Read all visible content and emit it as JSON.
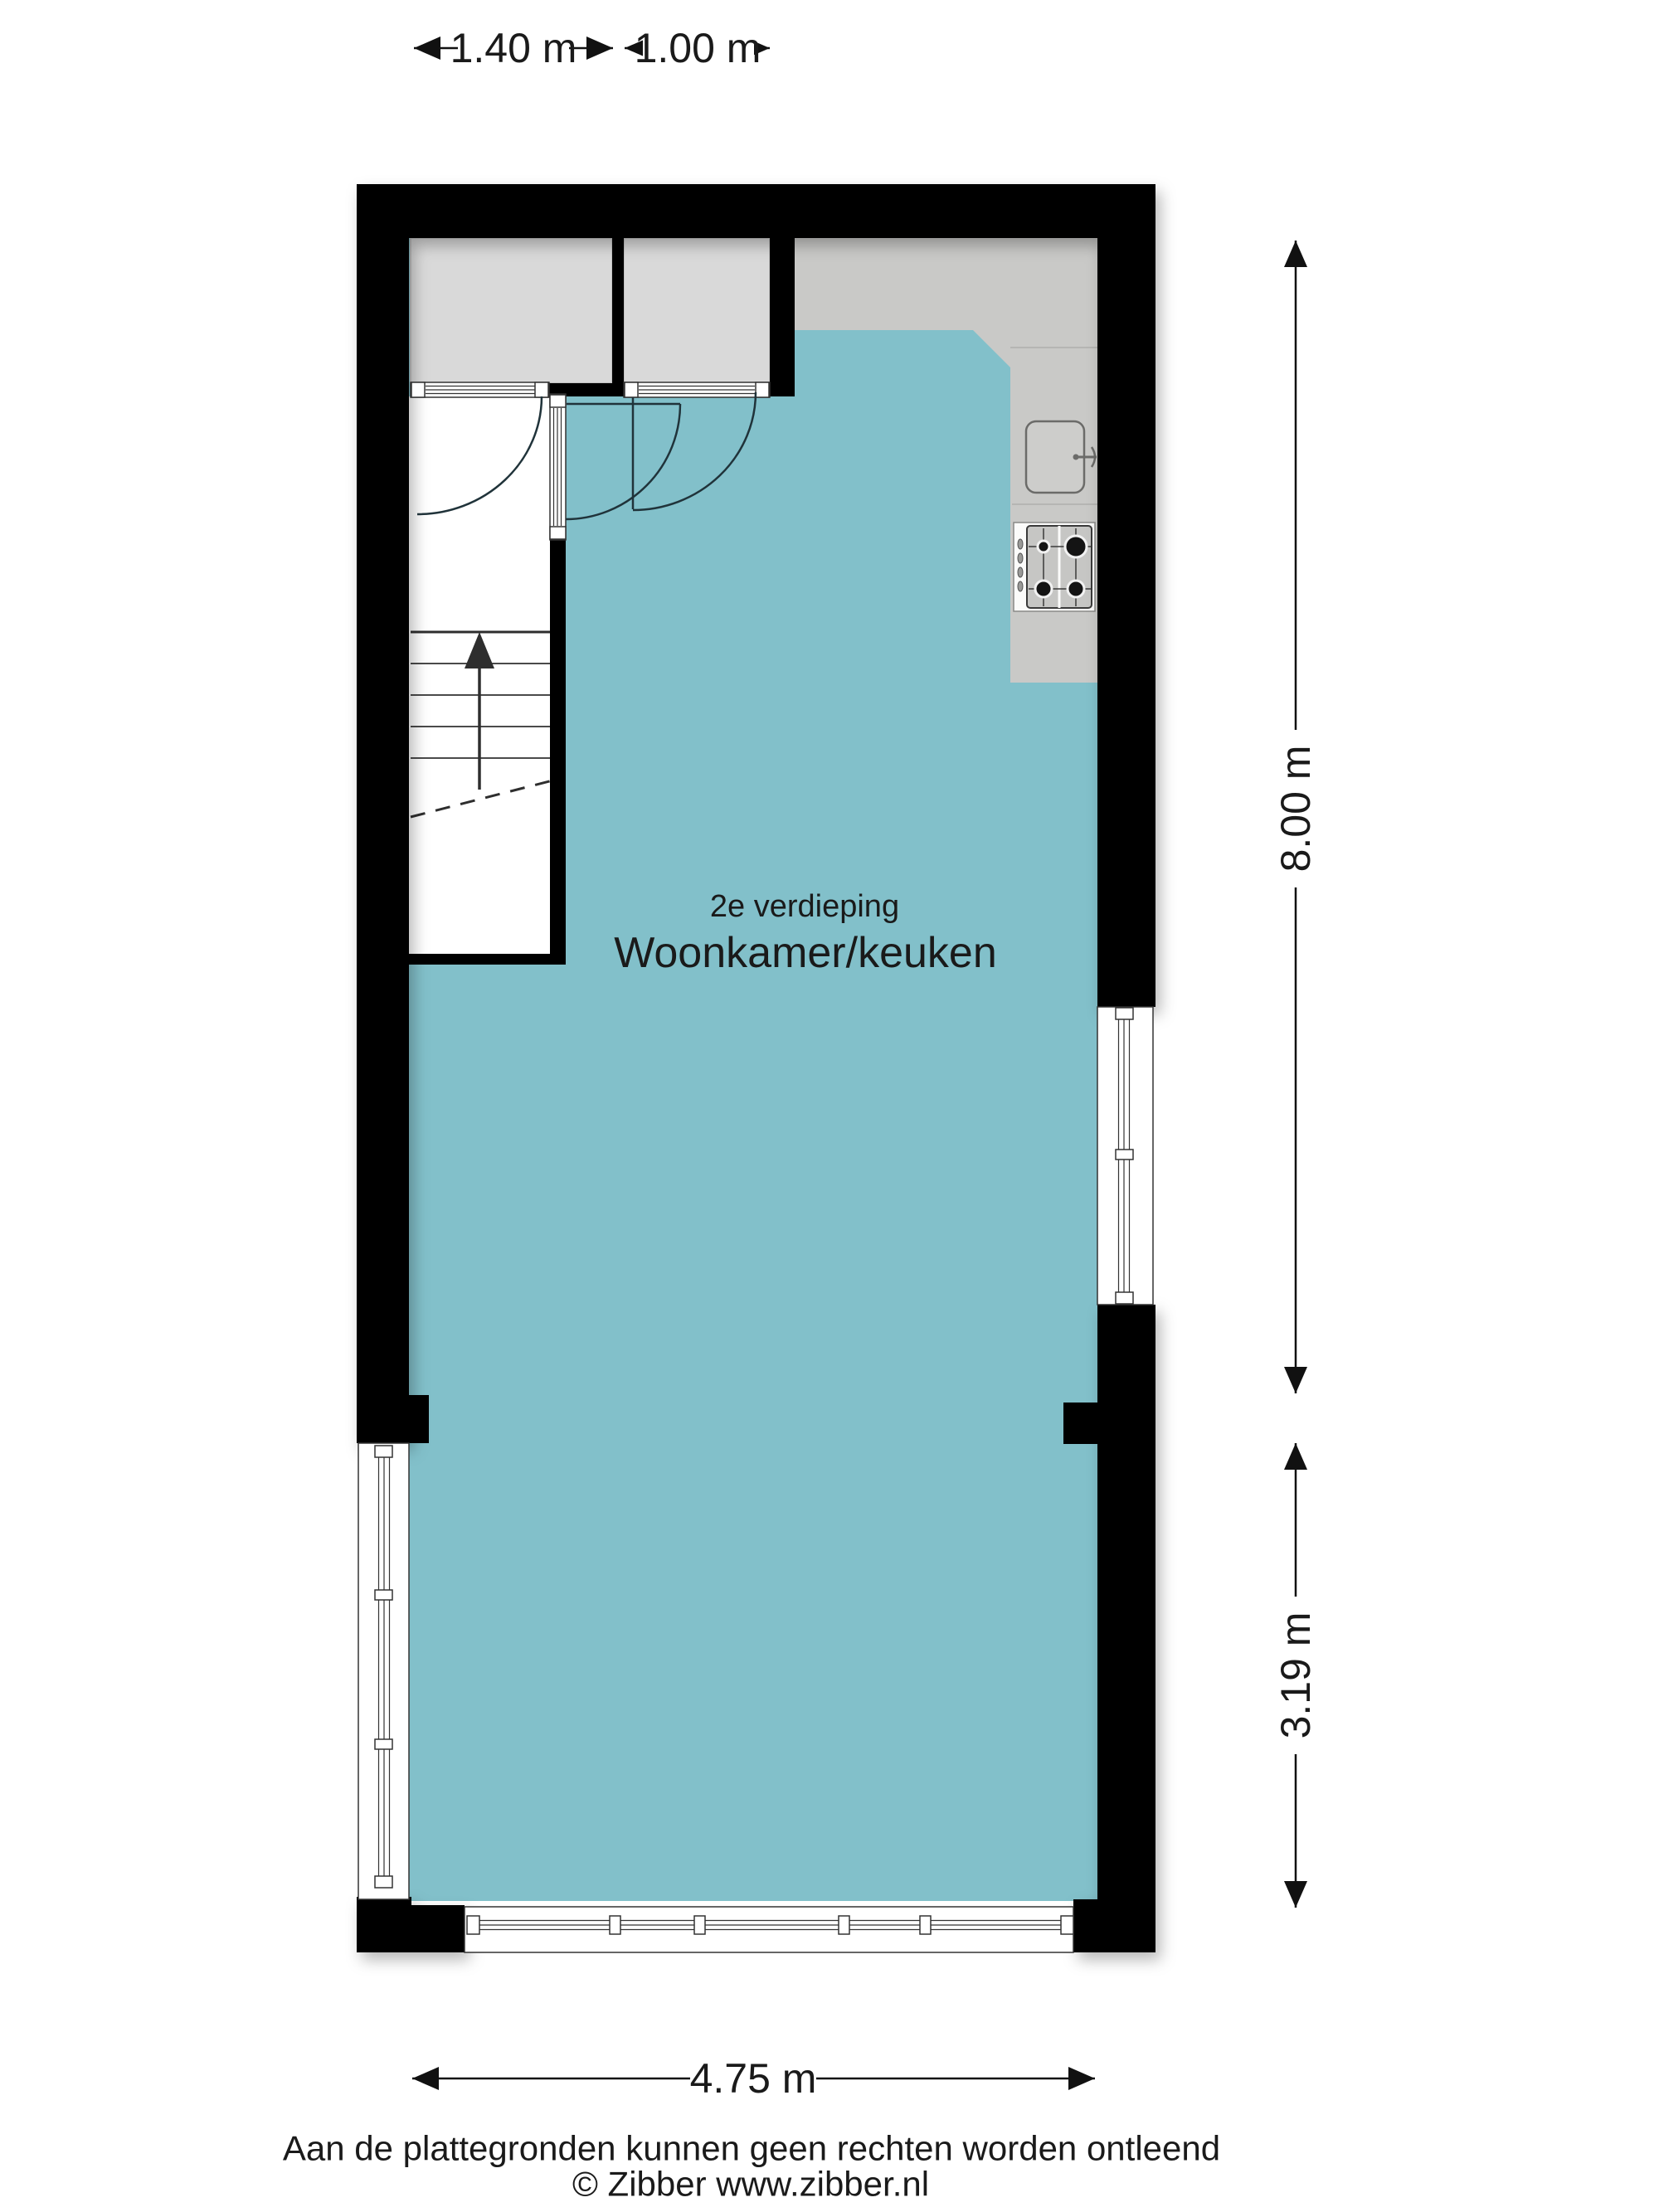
{
  "colors": {
    "wall": "#000000",
    "floor": "#82c0ca",
    "closet": "#d9d9d9",
    "counter": "#c9c9c7",
    "stove_panel": "#c6c6c4",
    "sink_fill": "#cdcdcb",
    "white": "#ffffff",
    "text": "#1a1a1a"
  },
  "dimensions": {
    "top_left": "1.40 m",
    "top_right": "1.00 m",
    "right_upper": "8.00 m",
    "right_lower": "3.19 m",
    "bottom": "4.75 m"
  },
  "room_label": {
    "floor": "2e verdieping",
    "name": "Woonkamer/keuken"
  },
  "footer": {
    "disclaimer": "Aan de plattegronden kunnen geen rechten worden ontleend",
    "copyright": "© Zibber www.zibber.nl"
  },
  "icons": {
    "stairs_direction": "up-arrow",
    "sink": "kitchen-sink",
    "stove": "four-burner-stove"
  }
}
